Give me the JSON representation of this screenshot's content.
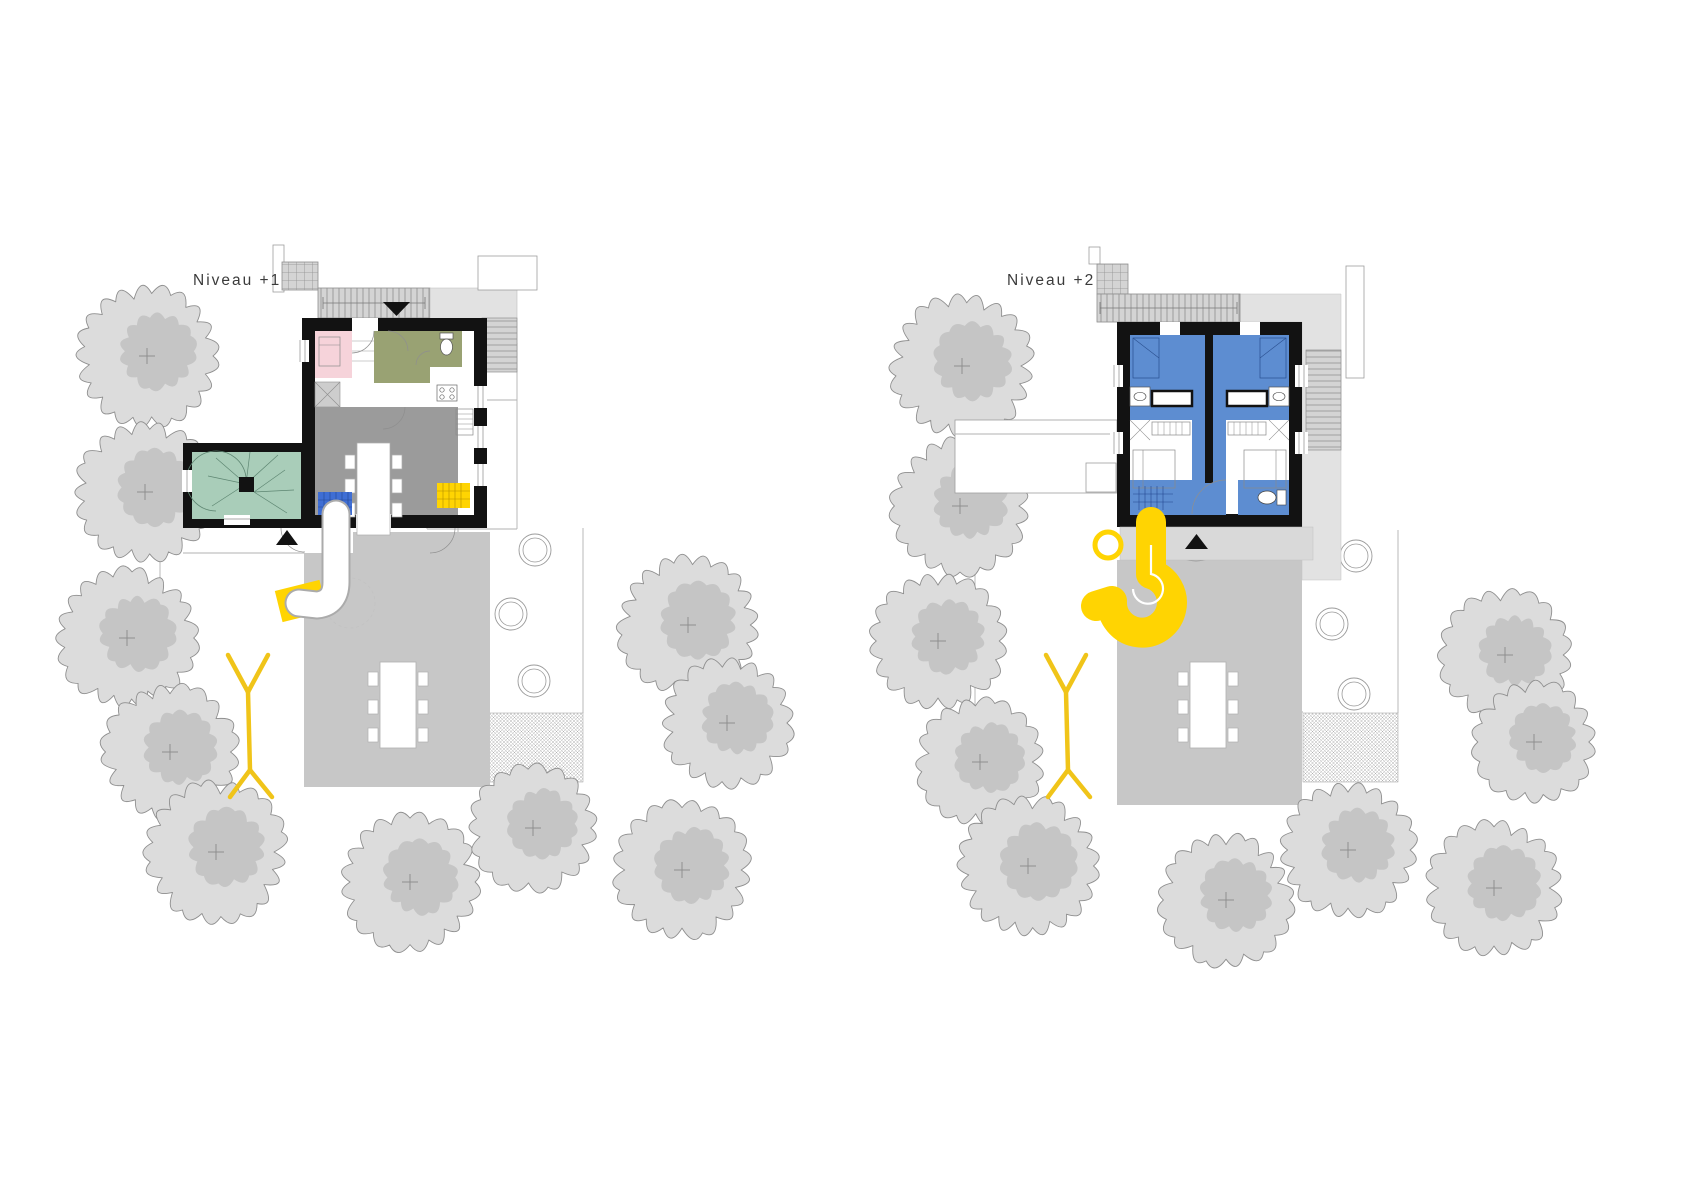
{
  "page": {
    "background": "#ffffff",
    "type": "architectural-site-plan",
    "views": 2
  },
  "colors": {
    "wall": "#121212",
    "pink": "#f6d3da",
    "olive": "#99a273",
    "teal": "#a9cdb9",
    "living_gray": "#9b9b9b",
    "terrace_gray": "#c7c7c7",
    "deck_gray": "#e2e2e2",
    "stair_gray": "#d4d4d4",
    "porch_gray": "#d9d9d9",
    "unit_blue": "#5d8dd1",
    "stair_blue": "#3f6ed4",
    "slide_yellow": "#ffd402",
    "stake_yellow": "#f0c419",
    "tree_fill": "#dcdcdc",
    "tree_inner": "#c5c5c5",
    "tree_outline": "#8f8f8f",
    "line_gray": "#b2b2b2",
    "text": "#3b3b3b"
  },
  "plans": [
    {
      "id": "level-1",
      "label": "Niveau +1",
      "trees": [
        [
          147,
          356,
          67
        ],
        [
          145,
          492,
          66
        ],
        [
          127,
          638,
          66
        ],
        [
          170,
          752,
          64
        ],
        [
          216,
          852,
          67
        ],
        [
          410,
          882,
          65
        ],
        [
          533,
          828,
          60
        ],
        [
          682,
          870,
          65
        ],
        [
          688,
          625,
          66
        ],
        [
          727,
          723,
          62
        ]
      ],
      "planters": [
        [
          535,
          550,
          16
        ],
        [
          511,
          614,
          16
        ],
        [
          534,
          681,
          16
        ]
      ],
      "gravel": [
        488,
        713,
        95,
        69
      ],
      "plot_lines": [
        [
          458,
          400,
          458,
          712
        ],
        [
          583,
          528,
          583,
          713
        ],
        [
          458,
          712,
          488,
          712
        ],
        [
          427,
          400,
          517,
          400
        ],
        [
          427,
          400,
          427,
          529
        ],
        [
          427,
          529,
          517,
          529
        ],
        [
          517,
          343,
          517,
          529
        ],
        [
          160,
          533,
          160,
          790
        ],
        [
          183,
          553,
          304,
          553
        ]
      ],
      "terrace_points": "304,553 353,553 353,532 490,532 490,787 304,787",
      "table": [
        380,
        662,
        36,
        86
      ],
      "stake": [
        [
          228,
          655,
          248,
          692
        ],
        [
          268,
          655,
          248,
          692
        ],
        [
          248,
          692,
          250,
          770
        ],
        [
          250,
          770,
          230,
          797
        ],
        [
          250,
          770,
          272,
          797
        ]
      ]
    },
    {
      "id": "level-2",
      "label": "Niveau +2",
      "trees": [
        [
          962,
          366,
          68
        ],
        [
          960,
          506,
          65
        ],
        [
          938,
          641,
          64
        ],
        [
          980,
          762,
          60
        ],
        [
          1028,
          866,
          66
        ],
        [
          1226,
          900,
          63
        ],
        [
          1348,
          850,
          64
        ],
        [
          1494,
          888,
          64
        ],
        [
          1505,
          655,
          62
        ],
        [
          1534,
          742,
          58
        ]
      ],
      "planters": [
        [
          1356,
          556,
          16
        ],
        [
          1332,
          624,
          16
        ],
        [
          1354,
          694,
          16
        ]
      ],
      "gravel": [
        1303,
        713,
        95,
        69
      ],
      "plot_lines": [
        [
          1273,
          560,
          1273,
          712
        ],
        [
          1398,
          530,
          1398,
          713
        ],
        [
          1273,
          712,
          1303,
          712
        ],
        [
          975,
          533,
          975,
          790
        ]
      ],
      "terrace_points": "1117,560 1302,560 1302,805 1117,805",
      "table": [
        1190,
        662,
        36,
        86
      ],
      "stake": [
        [
          1046,
          655,
          1066,
          692
        ],
        [
          1086,
          655,
          1066,
          692
        ],
        [
          1066,
          692,
          1068,
          770
        ],
        [
          1068,
          770,
          1048,
          797
        ],
        [
          1068,
          770,
          1090,
          797
        ]
      ]
    }
  ]
}
